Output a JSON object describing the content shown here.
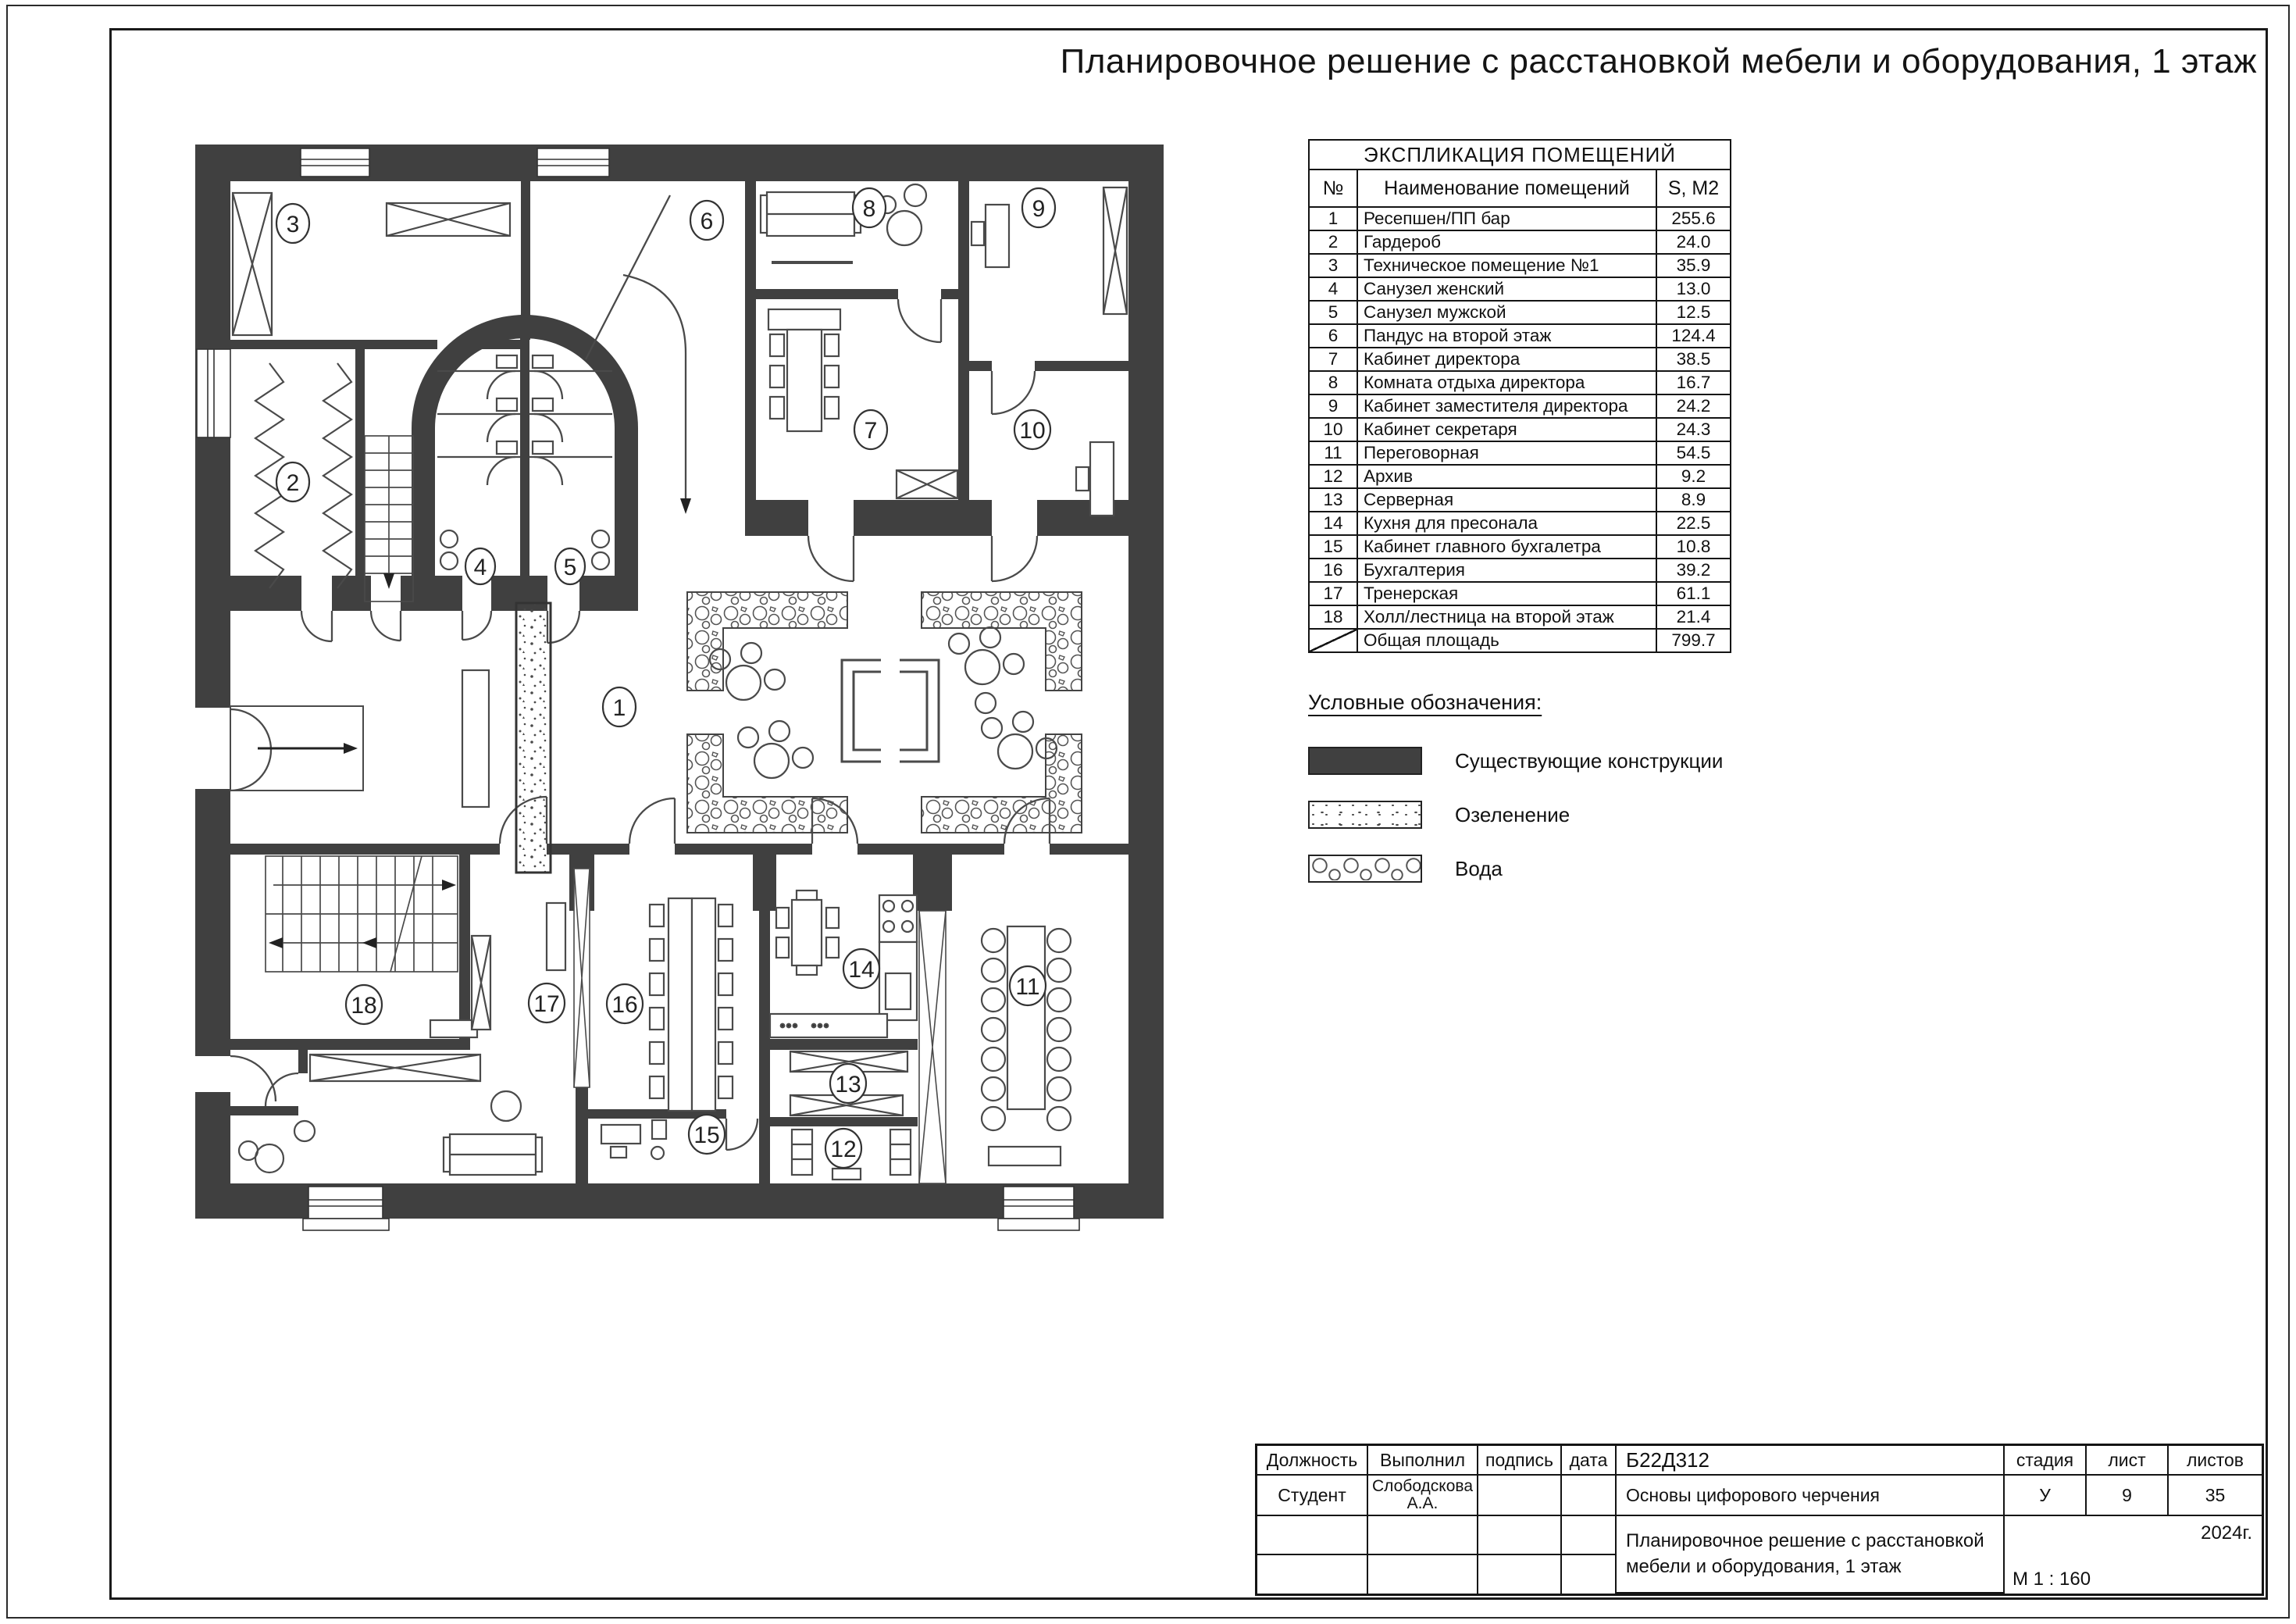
{
  "sheet": {
    "title": "Планировочное решение с расстановкой мебели и оборудования, 1 этаж"
  },
  "schedule": {
    "title": "ЭКСПЛИКАЦИЯ ПОМЕЩЕНИЙ",
    "columns": {
      "num": "№",
      "name": "Наименование помещений",
      "area": "S, М2"
    },
    "rows": [
      {
        "num": "1",
        "name": "Ресепшен/ПП бар",
        "area": "255.6"
      },
      {
        "num": "2",
        "name": "Гардероб",
        "area": "24.0"
      },
      {
        "num": "3",
        "name": "Техническое помещение №1",
        "area": "35.9"
      },
      {
        "num": "4",
        "name": "Санузел женский",
        "area": "13.0"
      },
      {
        "num": "5",
        "name": "Санузел мужской",
        "area": "12.5"
      },
      {
        "num": "6",
        "name": "Пандус на второй этаж",
        "area": "124.4"
      },
      {
        "num": "7",
        "name": "Кабинет директора",
        "area": "38.5"
      },
      {
        "num": "8",
        "name": "Комната отдыха директора",
        "area": "16.7"
      },
      {
        "num": "9",
        "name": "Кабинет заместителя директора",
        "area": "24.2"
      },
      {
        "num": "10",
        "name": "Кабинет секретаря",
        "area": "24.3"
      },
      {
        "num": "11",
        "name": "Переговорная",
        "area": "54.5"
      },
      {
        "num": "12",
        "name": "Архив",
        "area": "9.2"
      },
      {
        "num": "13",
        "name": "Серверная",
        "area": "8.9"
      },
      {
        "num": "14",
        "name": "Кухня для пресонала",
        "area": "22.5"
      },
      {
        "num": "15",
        "name": "Кабинет главного бухгалетра",
        "area": "10.8"
      },
      {
        "num": "16",
        "name": "Бухгалтерия",
        "area": "39.2"
      },
      {
        "num": "17",
        "name": "Тренерская",
        "area": "61.1"
      },
      {
        "num": "18",
        "name": "Холл/лестница на второй этаж",
        "area": "21.4"
      }
    ],
    "total": {
      "name": "Общая площадь",
      "area": "799.7"
    }
  },
  "legend": {
    "title": "Условные обозначения:",
    "items": [
      {
        "label": "Существующие конструкции"
      },
      {
        "label": "Озеленение"
      },
      {
        "label": "Вода"
      }
    ]
  },
  "plan": {
    "room_numbers": [
      "1",
      "2",
      "3",
      "4",
      "5",
      "6",
      "7",
      "8",
      "9",
      "10",
      "11",
      "12",
      "13",
      "14",
      "15",
      "16",
      "17",
      "18"
    ]
  },
  "titleblock": {
    "position_label": "Должность",
    "executed_label": "Выполнил",
    "signature_label": "подпись",
    "date_label": "дата",
    "doc_code": "Б22Д312",
    "role": "Студент",
    "executor_name": "Слободскова А.А.",
    "course": "Основы цифорового черчения",
    "stage_label": "стадия",
    "sheet_label": "лист",
    "sheets_label": "листов",
    "stage": "У",
    "sheet_no": "9",
    "sheets_total": "35",
    "drawing_title": "Планировочное решение с расстановкой мебели и оборудования, 1 этаж",
    "year": "2024г.",
    "scale": "М 1 : 160"
  },
  "colors": {
    "wall": "#404040",
    "line": "#4a4a4a"
  }
}
